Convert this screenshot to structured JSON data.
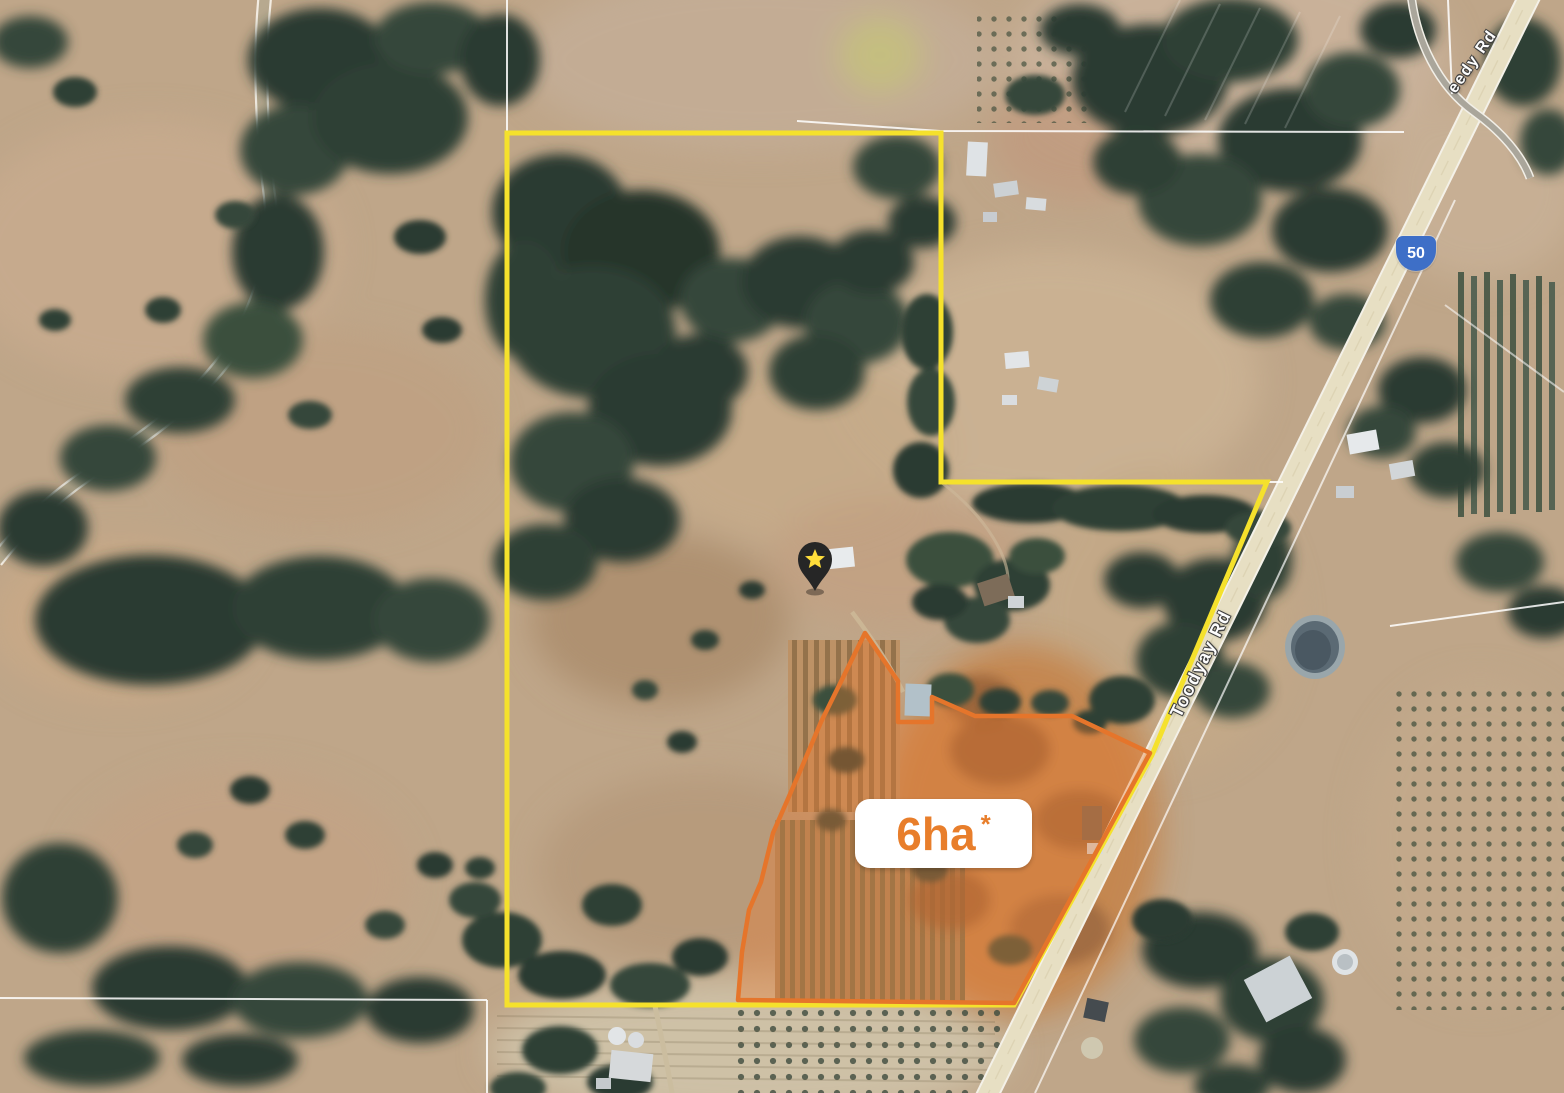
{
  "title": "Aerial property map",
  "area_badge": {
    "value": "6ha",
    "asterisk": "*"
  },
  "road_labels": {
    "main_road": "Toodyay Rd",
    "top_right_partial": "eedy Rd"
  },
  "route_shield": {
    "number": "50"
  },
  "marker": {
    "type": "map-pin-with-star"
  },
  "overlays": {
    "property_boundary_color": "#F5E12C",
    "highlight_stroke_color": "#E5752B",
    "highlight_fill_color": "rgba(233,124,49,0.38)",
    "badge_text_color": "#E87E2B",
    "shield_color": "#3E6FC7",
    "pin_body_color": "#262626",
    "pin_star_color": "#FFDE3B",
    "road_surface_color": "#E7DFC3"
  }
}
